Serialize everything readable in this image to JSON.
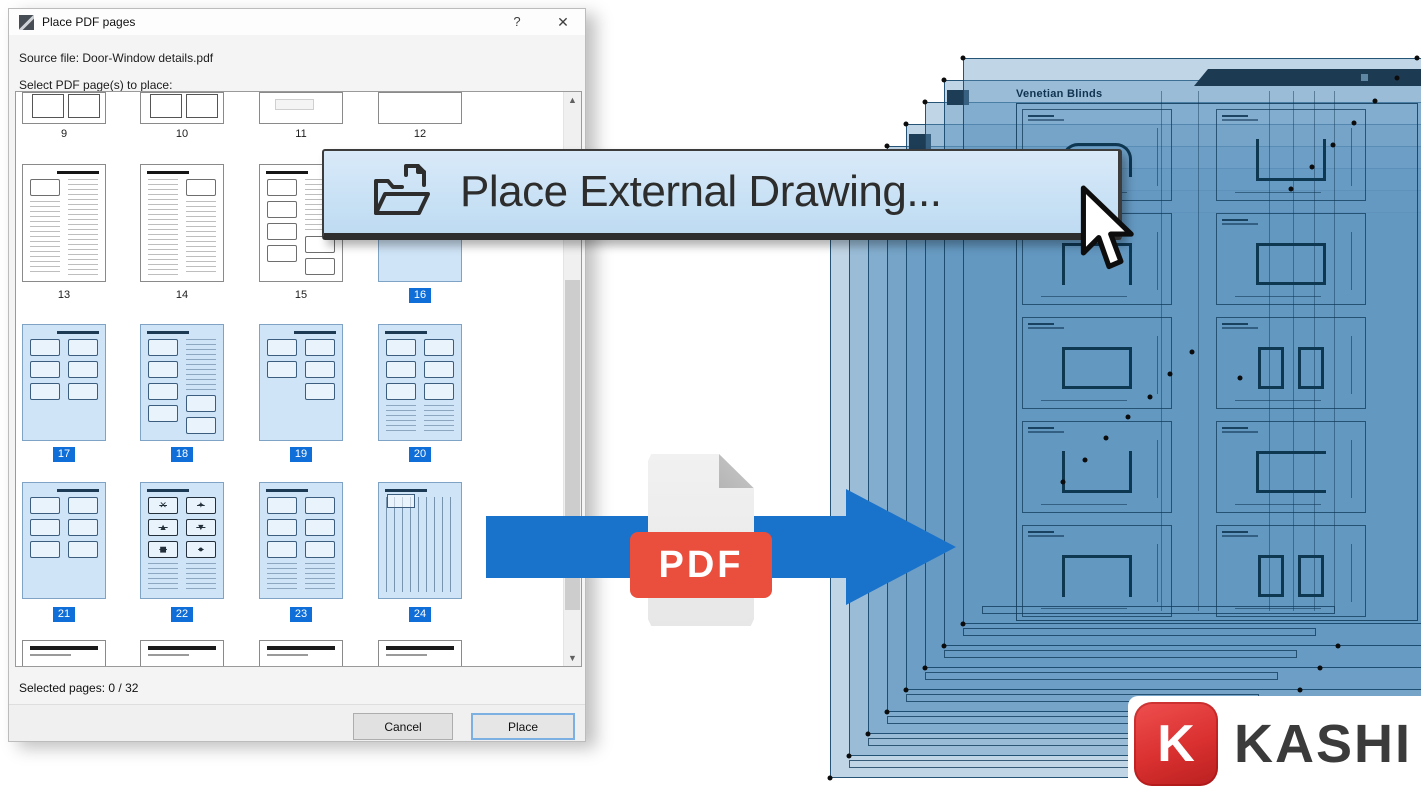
{
  "dialog": {
    "title": "Place PDF pages",
    "help": "?",
    "close": "✕",
    "source_file": "Source file: Door-Window details.pdf",
    "select_prompt": "Select PDF page(s) to place:",
    "status": "Selected pages: 0 / 32",
    "cancel": "Cancel",
    "place": "Place",
    "rows": [
      {
        "partial": "top",
        "pages": [
          {
            "num": "9",
            "selected": false,
            "variant": "mini"
          },
          {
            "num": "10",
            "selected": false,
            "variant": "mini"
          },
          {
            "num": "11",
            "selected": false,
            "variant": "faint"
          },
          {
            "num": "12",
            "selected": false,
            "variant": "blank"
          }
        ]
      },
      {
        "partial": null,
        "pages": [
          {
            "num": "13",
            "selected": false,
            "variant": "table"
          },
          {
            "num": "14",
            "selected": false,
            "variant": "table2"
          },
          {
            "num": "15",
            "selected": false,
            "variant": "partslist"
          },
          {
            "num": "16",
            "selected": true,
            "variant": "parts"
          }
        ]
      },
      {
        "partial": null,
        "pages": [
          {
            "num": "17",
            "selected": true,
            "variant": "parts"
          },
          {
            "num": "18",
            "selected": true,
            "variant": "partslist"
          },
          {
            "num": "19",
            "selected": true,
            "variant": "parts5"
          },
          {
            "num": "20",
            "selected": true,
            "variant": "partscol"
          }
        ]
      },
      {
        "partial": null,
        "pages": [
          {
            "num": "21",
            "selected": true,
            "variant": "parts"
          },
          {
            "num": "22",
            "selected": true,
            "variant": "symbols"
          },
          {
            "num": "23",
            "selected": true,
            "variant": "partscol"
          },
          {
            "num": "24",
            "selected": true,
            "variant": "stripes"
          }
        ]
      },
      {
        "partial": "bottom",
        "pages": [
          {
            "num": "",
            "selected": false,
            "variant": "header"
          },
          {
            "num": "",
            "selected": false,
            "variant": "header"
          },
          {
            "num": "",
            "selected": false,
            "variant": "header"
          },
          {
            "num": "",
            "selected": false,
            "variant": "header"
          }
        ]
      }
    ]
  },
  "flyout": {
    "label": "Place External Drawing..."
  },
  "pdf_badge": "PDF",
  "sheet": {
    "title": "Venetian Blinds",
    "cells": [
      [
        "hat",
        "ntop"
      ],
      [
        "nbottom",
        "rect"
      ],
      [
        "rect",
        "pair"
      ],
      [
        "ntop",
        "nright"
      ],
      [
        "nbottom",
        "pair"
      ]
    ]
  },
  "stack_dots": [
    [
      1192,
      352
    ],
    [
      1170,
      374
    ],
    [
      1150,
      397
    ],
    [
      1128,
      417
    ],
    [
      1106,
      438
    ],
    [
      1085,
      460
    ],
    [
      1063,
      482
    ],
    [
      1375,
      101
    ],
    [
      1354,
      123
    ],
    [
      1333,
      145
    ],
    [
      1312,
      167
    ],
    [
      1291,
      189
    ],
    [
      1417,
      58
    ],
    [
      1397,
      78
    ],
    [
      1240,
      378
    ],
    [
      1338,
      646
    ],
    [
      1320,
      668
    ],
    [
      1300,
      690
    ],
    [
      1172,
      758
    ]
  ],
  "logo": {
    "letter": "K",
    "name": "KASHI"
  },
  "colors": {
    "accent_blue": "#1a73cb",
    "selection_blue": "#0f6ed8",
    "pdf_red": "#ea4e3c",
    "sheet_navy": "#1c3a52",
    "logo_red": "#d92f2f"
  }
}
